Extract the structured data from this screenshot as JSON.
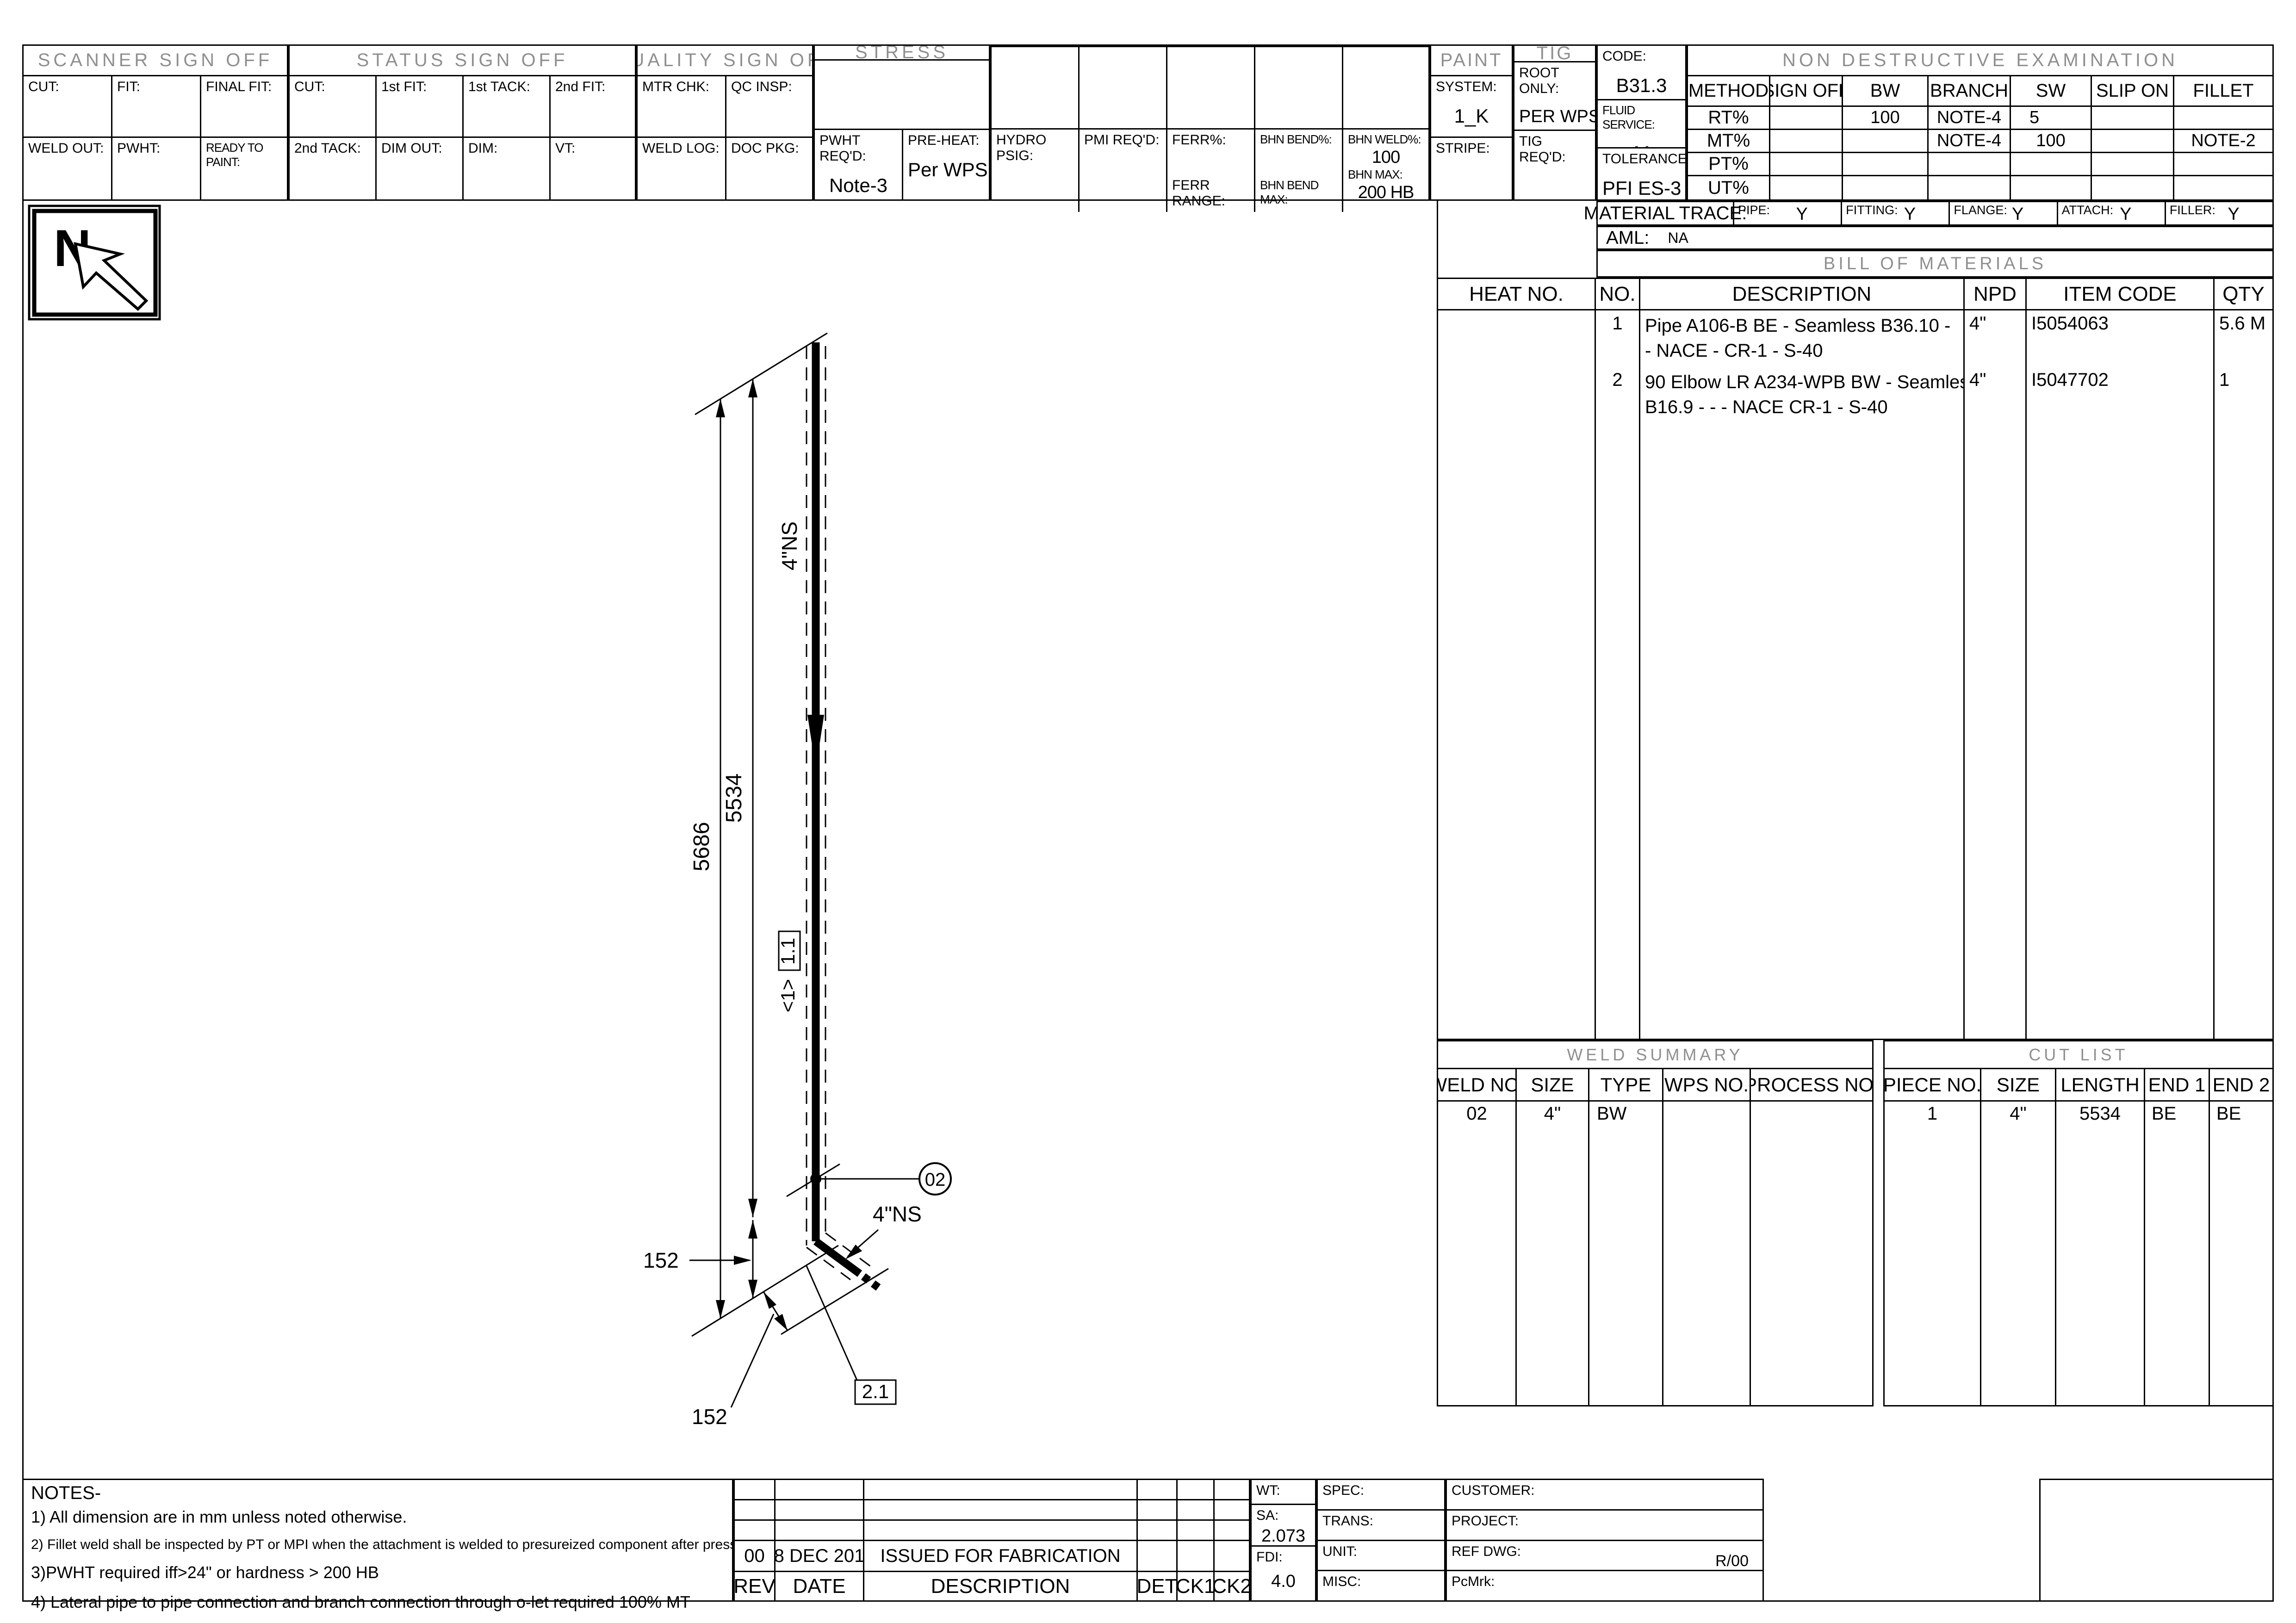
{
  "header": {
    "scanner": {
      "title": "SCANNER SIGN OFF",
      "cells": [
        "CUT:",
        "FIT:",
        "FINAL FIT:",
        "WELD OUT:",
        "PWHT:",
        "READY TO PAINT:"
      ]
    },
    "status": {
      "title": "STATUS SIGN OFF",
      "cells": [
        "CUT:",
        "1st FIT:",
        "1st TACK:",
        "2nd FIT:",
        "2nd TACK:",
        "DIM OUT:",
        "DIM:",
        "VT:"
      ]
    },
    "quality": {
      "title": "QUALITY SIGN OFF",
      "cells": [
        "MTR CHK:",
        "QC INSP:",
        "WELD LOG:",
        "DOC PKG:"
      ]
    },
    "stress": {
      "title": "STRESS",
      "pwht_label": "PWHT REQ'D:",
      "pwht_value": "Note-3",
      "preheat_label": "PRE-HEAT:",
      "preheat_value": "Per WPS"
    },
    "additional": {
      "title": "ADDITIONAL TESTING",
      "hydro": "HYDRO PSIG:",
      "pmi": "PMI REQ'D:",
      "ferr": "FERR%:",
      "ferr_range": "FERR RANGE:",
      "bhn_bend": "BHN BEND%:",
      "bhn_bend_max": "BHN BEND MAX:",
      "bhn_weld": "BHN WELD%:",
      "bhn_weld_value": "100",
      "bhn_max": "BHN MAX:",
      "bhn_max_value": "200 HB"
    },
    "paint": {
      "title": "PAINT",
      "system_label": "SYSTEM:",
      "system_value": "1_K",
      "stripe_label": "STRIPE:"
    },
    "tig": {
      "title": "TIG",
      "root_label": "ROOT ONLY:",
      "root_value": "PER WPS",
      "req_label": "TIG REQ'D:"
    },
    "code": {
      "code_label": "CODE:",
      "code_value": "B31.3",
      "fluid_label": "FLUID SERVICE:",
      "fluid_value": "M",
      "tol_label": "TOLERANCE:",
      "tol_value": "PFI ES-3"
    },
    "nde": {
      "title": "NON  DESTRUCTIVE  EXAMINATION",
      "cols": [
        "METHOD",
        "SIGN OFF",
        "BW",
        "BRANCH",
        "SW",
        "SLIP ON",
        "FILLET"
      ],
      "rows": [
        {
          "method": "RT%",
          "signoff": "",
          "bw": "100",
          "branch": "NOTE-4",
          "sw": "5",
          "slipon": "",
          "fillet": ""
        },
        {
          "method": "MT%",
          "signoff": "",
          "bw": "",
          "branch": "NOTE-4",
          "sw": "100",
          "slipon": "",
          "fillet": "NOTE-2"
        },
        {
          "method": "PT%",
          "signoff": "",
          "bw": "",
          "branch": "",
          "sw": "",
          "slipon": "",
          "fillet": ""
        },
        {
          "method": "UT%",
          "signoff": "",
          "bw": "",
          "branch": "",
          "sw": "",
          "slipon": "",
          "fillet": ""
        }
      ]
    }
  },
  "material_trace": {
    "label": "MATERIAL TRACE:",
    "items": [
      {
        "k": "PIPE:",
        "v": "Y"
      },
      {
        "k": "FITTING:",
        "v": "Y"
      },
      {
        "k": "FLANGE:",
        "v": "Y"
      },
      {
        "k": "ATTACH:",
        "v": "Y"
      },
      {
        "k": "FILLER:",
        "v": "Y"
      }
    ]
  },
  "aml": {
    "label": "AML:",
    "value": "NA"
  },
  "bom": {
    "title": "BILL  OF  MATERIALS",
    "cols": [
      "HEAT NO.",
      "NO.",
      "DESCRIPTION",
      "NPD",
      "ITEM CODE",
      "QTY"
    ],
    "rows": [
      {
        "no": "1",
        "desc1": "Pipe A106-B BE - Seamless B36.10 -",
        "desc2": "- NACE - CR-1 -   S-40",
        "npd": "4\"",
        "item": "I5054063",
        "qty": "5.6 M"
      },
      {
        "no": "2",
        "desc1": "90 Elbow LR A234-WPB BW - Seamless",
        "desc2": "B16.9 - - - NACE CR-1 -   S-40",
        "npd": "4\"",
        "item": "I5047702",
        "qty": "1"
      }
    ]
  },
  "weld_summary": {
    "title": "WELD  SUMMARY",
    "cols": [
      "WELD NO.",
      "SIZE",
      "TYPE",
      "WPS NO.",
      "PROCESS NO."
    ],
    "row": [
      "02",
      "4\"",
      "BW",
      "",
      ""
    ]
  },
  "cut_list": {
    "title": "CUT  LIST",
    "cols": [
      "PIECE NO.",
      "SIZE",
      "LENGTH",
      "END 1",
      "END 2"
    ],
    "row": [
      "1",
      "4\"",
      "5534",
      "BE",
      "BE"
    ]
  },
  "notes": {
    "title": "NOTES-",
    "lines": [
      "1) All dimension are in mm unless noted otherwise.",
      "2) Fillet weld shall be inspected by PT or MPI when the attachment is welded to presureized component after pressure test.",
      "3)PWHT required iff>24\" or hardness > 200 HB",
      "4) Lateral pipe to pipe connection and branch connection through o-let required 100% MT",
      "RT 100% for configurations as per ASME B31.3 328.5.44E; tee accessories comparable to butt joints"
    ]
  },
  "rev_block": {
    "cols": [
      "REV",
      "DATE",
      "DESCRIPTION",
      "DET",
      "CK1",
      "CK2"
    ],
    "row": {
      "rev": "00",
      "date": "08 DEC 2019",
      "desc": "ISSUED FOR FABRICATION"
    }
  },
  "info_block": {
    "wt_label": "WT:",
    "sa_label": "SA:",
    "sa_value": "2.073",
    "fdi_label": "FDI:",
    "fdi_value": "4.0",
    "spec_label": "SPEC:",
    "trans_label": "TRANS:",
    "unit_label": "UNIT:",
    "misc_label": "MISC:",
    "customer_label": "CUSTOMER:",
    "project_label": "PROJECT:",
    "ref_dwg_label": "REF DWG:",
    "ref_dwg_value": "R/00",
    "pcmrk_label": "PcMrk:"
  },
  "drawing": {
    "north": "N",
    "line_size": "4\"NS",
    "branch_size": "4\"NS",
    "dim_total": "5686",
    "dim_to_weld": "5534",
    "dim_elbow": "152",
    "dim_branch": "152",
    "weld_no": "02",
    "spool": "1.1",
    "flow": "<1>",
    "detail": "2.1"
  }
}
